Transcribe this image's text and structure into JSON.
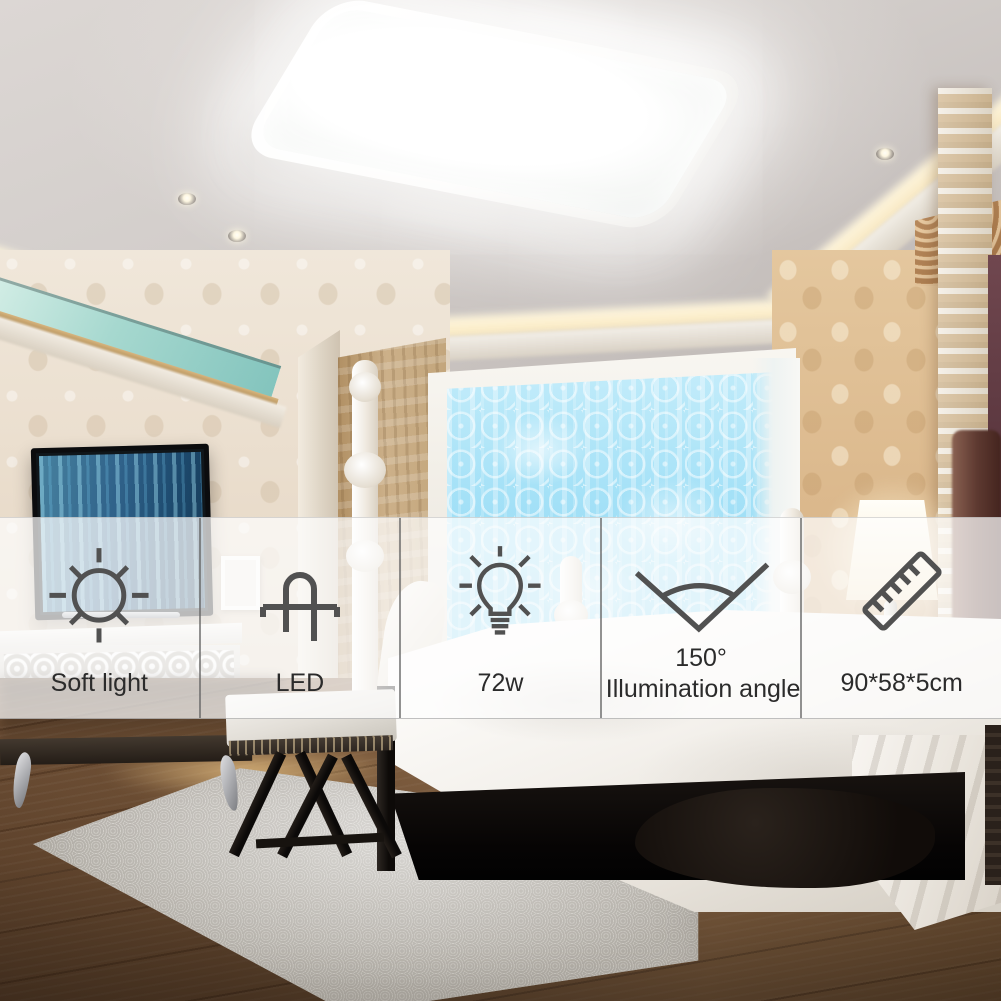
{
  "overlay": {
    "features": [
      {
        "icon": "sun-icon",
        "label": "Soft light"
      },
      {
        "icon": "led-diode-icon",
        "label": "LED"
      },
      {
        "icon": "light-bulb-icon",
        "label": "72w"
      },
      {
        "icon": "illumination-angle-icon",
        "value": "150°",
        "label": "Illumination angle"
      },
      {
        "icon": "ruler-icon",
        "label": "90*58*5cm"
      }
    ]
  },
  "colors": {
    "band_background": "rgba(253,253,254,0.72)",
    "band_divider": "rgba(100,100,100,0.7)",
    "icon_stroke": "#515151",
    "label_text": "#2b2b2b",
    "curtain_blue": "#a4e1f7",
    "cove_glow": "#fff7e0",
    "wood_floor": "#6f5036",
    "duvet_white": "#fdfcfa"
  }
}
